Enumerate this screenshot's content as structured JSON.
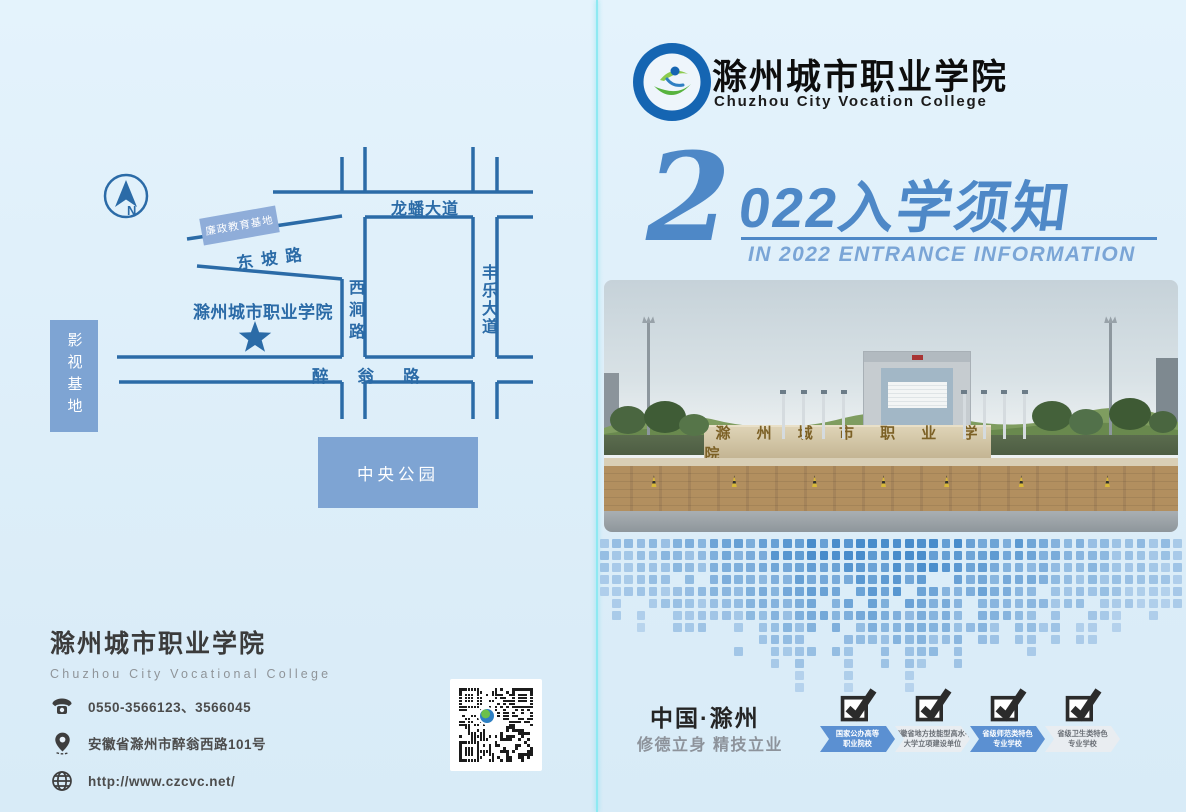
{
  "brand": {
    "logo_title": "滁州城市职业学院",
    "logo_subtitle": "Chuzhou City Vocation College"
  },
  "title": {
    "digit": "2",
    "year_text": "022入学须知",
    "subtitle_en": "IN 2022 ENTRANCE INFORMATION"
  },
  "photo": {
    "gate_text": "滁 州 城 市 职 业 学 院"
  },
  "map": {
    "compass": "N",
    "roads": {
      "longpan": "龙蟠大道",
      "fengle": "丰乐大道",
      "xijian": "西涧路",
      "dongpo": "东坡路",
      "zuiweng": "醉翁路"
    },
    "places": {
      "lianzheng": "廉政教育基地",
      "college": "滁州城市职业学院",
      "yingshi": "影视基地",
      "zhongyang": "中央公园"
    }
  },
  "contact": {
    "name_cn": "滁州城市职业学院",
    "name_en": "Chuzhou City Vocational College",
    "phone": "0550-3566123、3566045",
    "address": "安徽省滁州市醉翁西路101号",
    "website": "http://www.czcvc.net/"
  },
  "footer": {
    "location": "中国·滁州",
    "motto": "修德立身 精技立业",
    "badges": [
      {
        "line1": "国家公办高等",
        "line2": "职业院校"
      },
      {
        "line1": "安徽省地方技能型高水平",
        "line2": "大学立项建设单位"
      },
      {
        "line1": "省级师范类特色",
        "line2": "专业学校"
      },
      {
        "line1": "省级卫生类特色",
        "line2": "专业学校"
      }
    ]
  },
  "colors": {
    "accent_blue": "#4e88c7",
    "road_blue": "#2b6ba7",
    "block_blue": "#7ea4d3",
    "fold_cyan": "#8ee9f2"
  }
}
